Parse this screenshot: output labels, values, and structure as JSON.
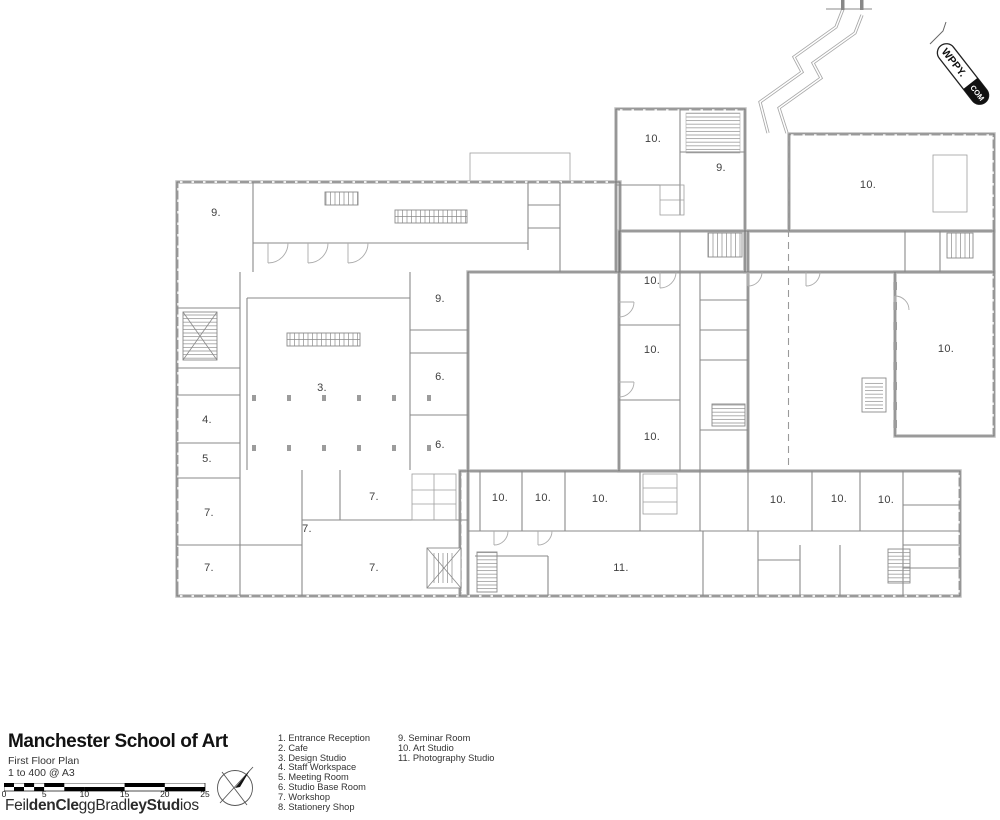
{
  "watermark": {
    "text_main": "WPPY.",
    "text_tld": "COM"
  },
  "title_block": {
    "title": "Manchester School of Art",
    "subtitle": "First Floor Plan",
    "scale_note": "1 to 400 @ A3",
    "scale_labels": [
      "0",
      "5",
      "10",
      "15",
      "20",
      "25"
    ],
    "firm_segments": [
      {
        "text": "Feil",
        "bold": false
      },
      {
        "text": "denCle",
        "bold": true
      },
      {
        "text": "gg",
        "bold": false
      },
      {
        "text": "Bradl",
        "bold": false
      },
      {
        "text": "eyStud",
        "bold": true
      },
      {
        "text": "ios",
        "bold": false
      }
    ]
  },
  "legend": {
    "column1": [
      "1. Entrance Reception",
      "2. Cafe",
      "3. Design Studio",
      "4. Staff Workspace",
      "5. Meeting Room",
      "6. Studio Base Room",
      "7. Workshop",
      "8. Stationery Shop"
    ],
    "column2": [
      "9. Seminar Room",
      "10. Art Studio",
      "11. Photography Studio"
    ]
  },
  "room_labels": [
    {
      "text": "9.",
      "x": 216,
      "y": 213
    },
    {
      "text": "10.",
      "x": 653,
      "y": 139
    },
    {
      "text": "9.",
      "x": 721,
      "y": 168
    },
    {
      "text": "10.",
      "x": 868,
      "y": 185
    },
    {
      "text": "9.",
      "x": 440,
      "y": 299
    },
    {
      "text": "10.",
      "x": 652,
      "y": 281
    },
    {
      "text": "10.",
      "x": 652,
      "y": 350
    },
    {
      "text": "10.",
      "x": 946,
      "y": 349
    },
    {
      "text": "3.",
      "x": 322,
      "y": 388
    },
    {
      "text": "6.",
      "x": 440,
      "y": 377
    },
    {
      "text": "4.",
      "x": 207,
      "y": 420
    },
    {
      "text": "10.",
      "x": 652,
      "y": 437
    },
    {
      "text": "6.",
      "x": 440,
      "y": 445
    },
    {
      "text": "5.",
      "x": 207,
      "y": 459
    },
    {
      "text": "10.",
      "x": 500,
      "y": 498
    },
    {
      "text": "10.",
      "x": 543,
      "y": 498
    },
    {
      "text": "10.",
      "x": 600,
      "y": 499
    },
    {
      "text": "10.",
      "x": 778,
      "y": 500
    },
    {
      "text": "10.",
      "x": 839,
      "y": 499
    },
    {
      "text": "10.",
      "x": 886,
      "y": 500
    },
    {
      "text": "7.",
      "x": 209,
      "y": 513
    },
    {
      "text": "7.",
      "x": 374,
      "y": 497
    },
    {
      "text": "7.",
      "x": 307,
      "y": 529
    },
    {
      "text": "7.",
      "x": 209,
      "y": 568
    },
    {
      "text": "7.",
      "x": 374,
      "y": 568
    },
    {
      "text": "11.",
      "x": 621,
      "y": 568
    }
  ]
}
